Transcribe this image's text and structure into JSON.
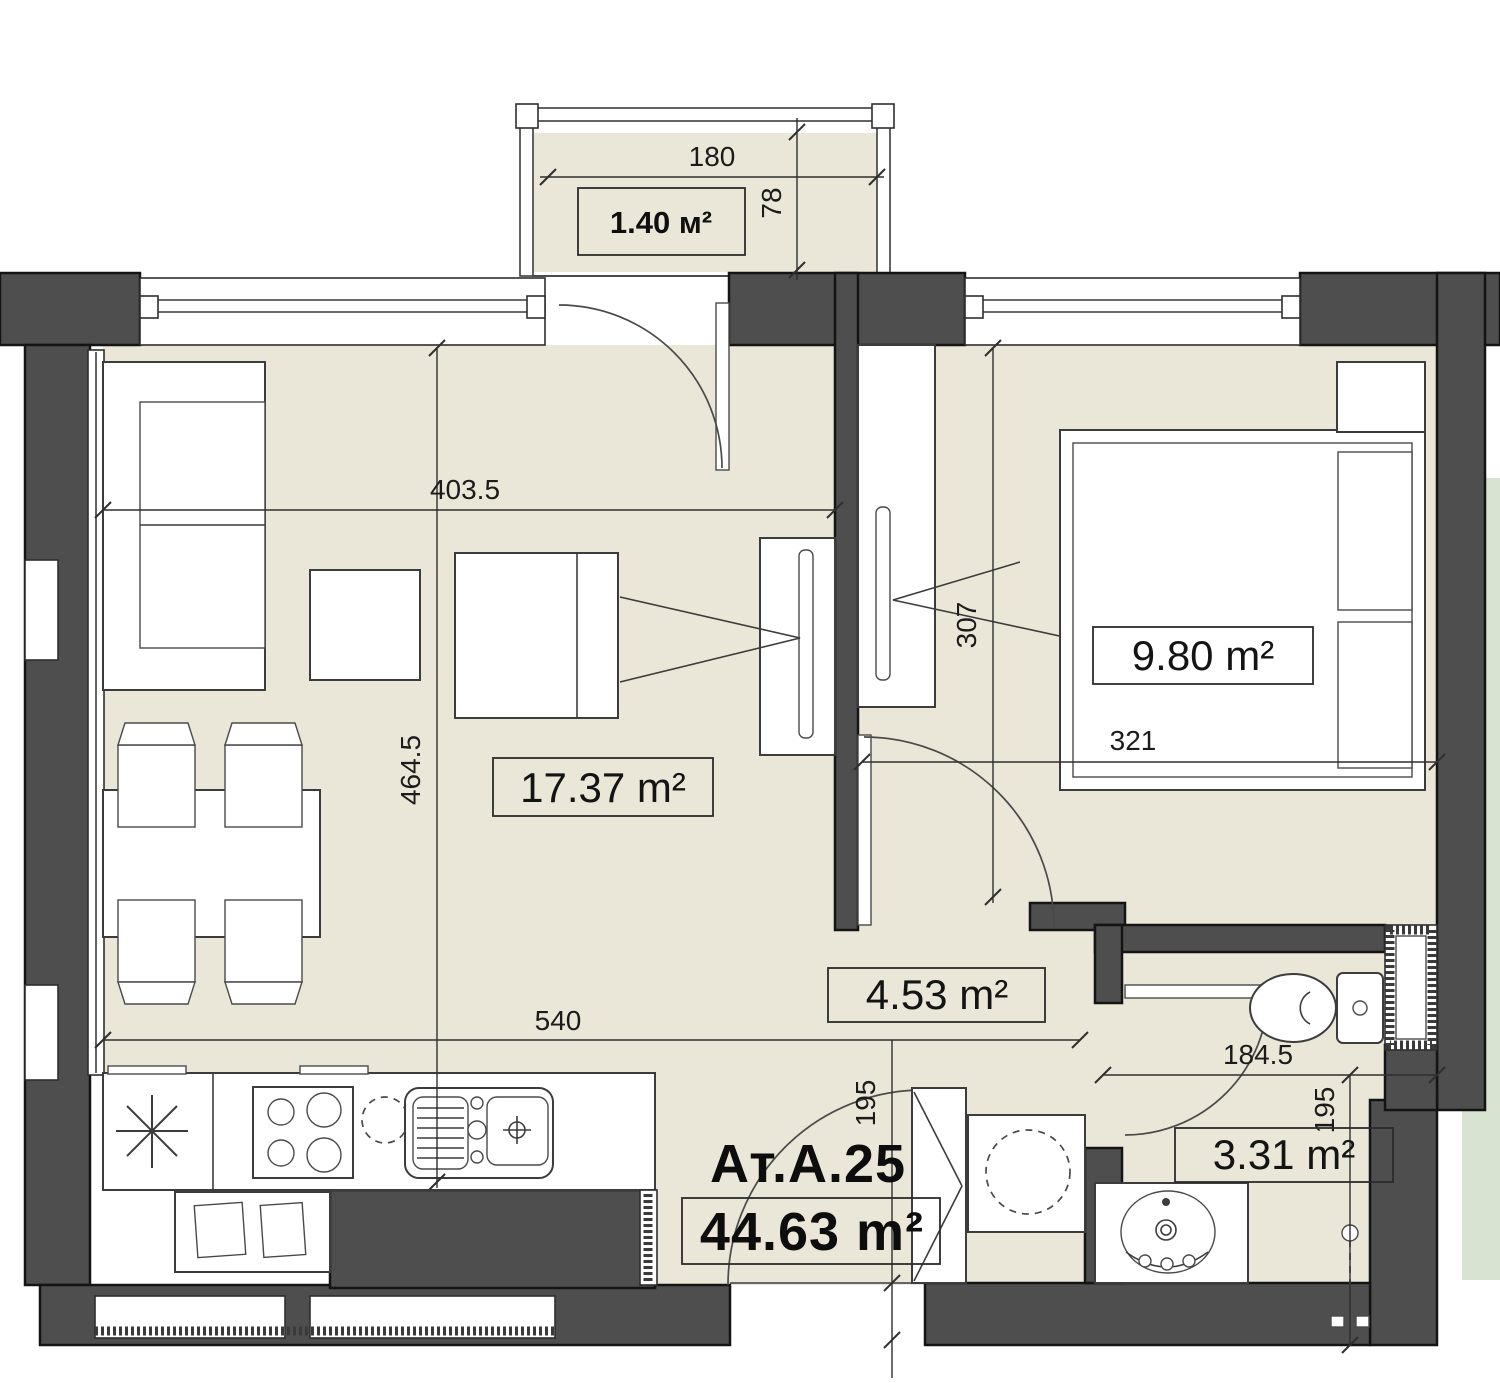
{
  "unit": {
    "label": "Ат.А.25",
    "area": "44.63 m²"
  },
  "rooms": {
    "balcony": {
      "area": "1.40 м²"
    },
    "living": {
      "area": "17.37 m²"
    },
    "bedroom": {
      "area": "9.80 m²"
    },
    "hall": {
      "area": "4.53 m²"
    },
    "bath": {
      "area": "3.31 m²"
    }
  },
  "dimensions": {
    "balcony_width": "180",
    "balcony_depth": "78",
    "living_width": "403.5",
    "living_depth": "464.5",
    "living_full_width": "540",
    "bedroom_depth": "307",
    "bedroom_width": "321",
    "entry_depth": "195",
    "bath_width": "184.5",
    "bath_depth": "195"
  },
  "colors": {
    "wall": "#4e4e4e",
    "floor": "#eae6d8",
    "adjacent_floor": "#d8e3d2",
    "outline": "#1c1c1c",
    "background": "#ffffff"
  }
}
